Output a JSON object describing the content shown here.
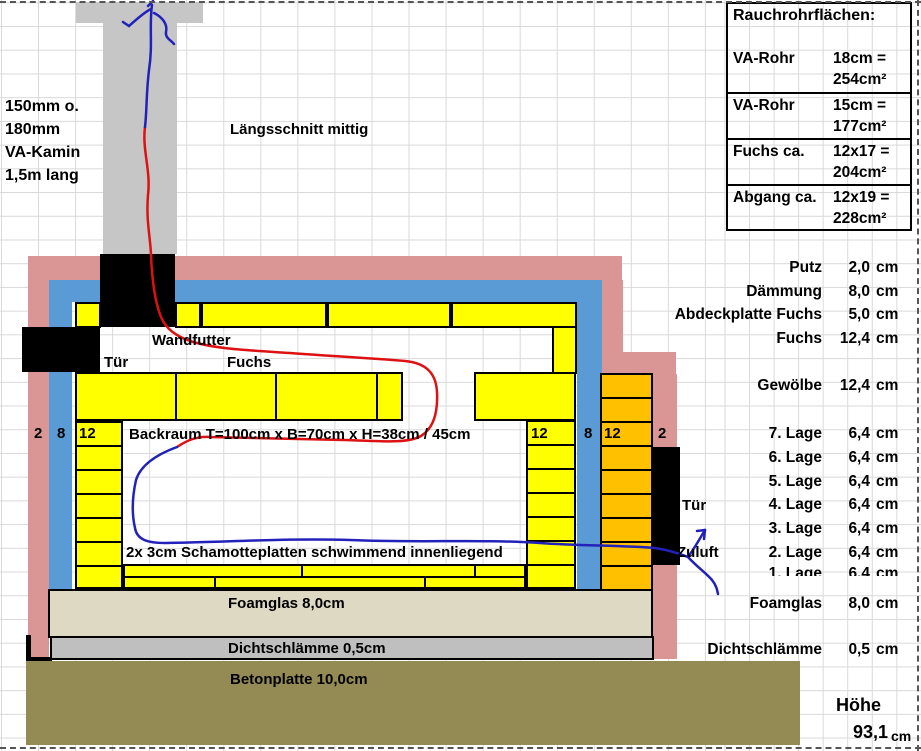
{
  "title": "Längsschnitt mittig",
  "chimney_note": {
    "line1": "150mm o.",
    "line2": "180mm",
    "line3": "VA-Kamin",
    "line4": "1,5m lang"
  },
  "rauchrohr_table": {
    "title": "Rauchrohrflächen:",
    "rows": [
      {
        "label": "VA-Rohr",
        "formula": "18cm =",
        "result": "254cm²"
      },
      {
        "label": "VA-Rohr",
        "formula": "15cm =",
        "result": "177cm²"
      },
      {
        "label": "Fuchs ca.",
        "formula": "12x17 =",
        "result": "204cm²"
      },
      {
        "label": "Abgang ca.",
        "formula": "12x19 =",
        "result": "228cm²"
      }
    ]
  },
  "diagram": {
    "wandfutter": "Wandfutter",
    "tuer_left": "Tür",
    "fuchs": "Fuchs",
    "backraum": "Backraum T=100cm x B=70cm x H=38cm / 45cm",
    "schamotte": "2x 3cm Schamotteplatten schwimmend innenliegend",
    "foamglas": "Foamglas 8,0cm",
    "dichtschlaemme": "Dichtschlämme 0,5cm",
    "betonplatte": "Betonplatte 10,0cm",
    "tuer_right": "Tür",
    "zuluft": "Zuluft",
    "wall_left": {
      "putz": "2",
      "daemmung": "8",
      "stein": "12"
    },
    "wall_right": {
      "stein_innen": "12",
      "daemmung": "8",
      "stein_aussen": "12",
      "putz": "2"
    }
  },
  "layer_list": {
    "rows": [
      {
        "label": "Putz",
        "value": "2,0",
        "unit": "cm"
      },
      {
        "label": "Dämmung",
        "value": "8,0",
        "unit": "cm"
      },
      {
        "label": "Abdeckplatte Fuchs",
        "value": "5,0",
        "unit": "cm"
      },
      {
        "label": "Fuchs",
        "value": "12,4",
        "unit": "cm"
      },
      {
        "label": "Gewölbe",
        "value": "12,4",
        "unit": "cm"
      },
      {
        "label": "7. Lage",
        "value": "6,4",
        "unit": "cm"
      },
      {
        "label": "6. Lage",
        "value": "6,4",
        "unit": "cm"
      },
      {
        "label": "5. Lage",
        "value": "6,4",
        "unit": "cm"
      },
      {
        "label": "4. Lage",
        "value": "6,4",
        "unit": "cm"
      },
      {
        "label": "3. Lage",
        "value": "6,4",
        "unit": "cm"
      },
      {
        "label": "2. Lage",
        "value": "6,4",
        "unit": "cm"
      },
      {
        "label": "1. Lage",
        "value": "6,4",
        "unit": "cm"
      },
      {
        "label": "Foamglas",
        "value": "8,0",
        "unit": "cm"
      },
      {
        "label": "Dichtschlämme",
        "value": "0,5",
        "unit": "cm"
      }
    ],
    "total": {
      "label": "Höhe",
      "value": "93,1",
      "unit": "cm"
    }
  },
  "colors": {
    "putz": "#D99694",
    "daemmung": "#5B9BD5",
    "schamotte_gelb": "#FFFF00",
    "klinker_orange": "#FFC000",
    "foamglas": "#DDD9C3",
    "dichtschlaemme": "#BFBFBF",
    "beton": "#948A54",
    "kamin_grau": "#C6C6C6",
    "rauch_rot": "#DD1111",
    "luft_blau": "#2222BB"
  }
}
